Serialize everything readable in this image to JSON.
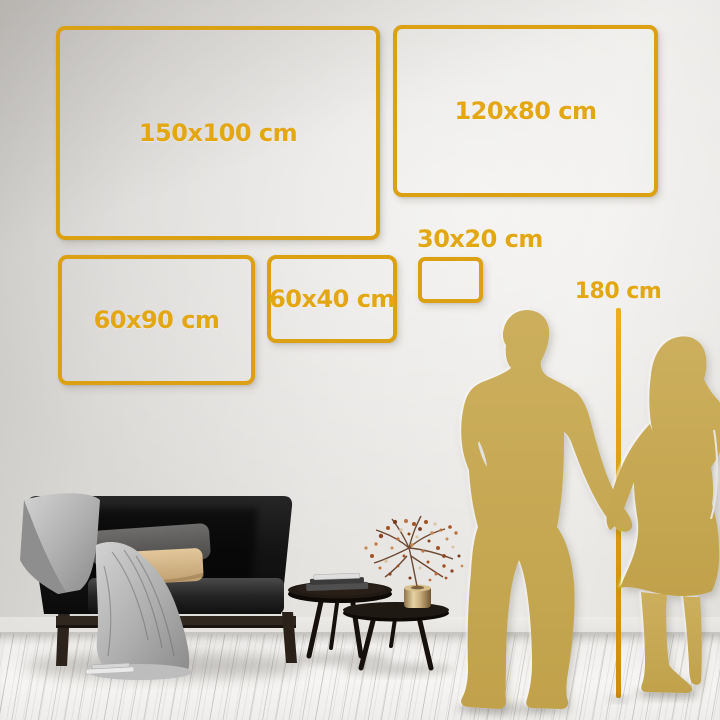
{
  "size_comparison": {
    "frames": [
      {
        "label": "150x100 cm"
      },
      {
        "label": "120x80 cm"
      },
      {
        "label": "60x90 cm"
      },
      {
        "label": "60x40 cm"
      },
      {
        "label": "30x20 cm"
      }
    ],
    "height_marker_label": "180 cm"
  },
  "colors": {
    "frame_gold": "#dca112",
    "label_gold": "#e3a714",
    "silhouette_gold": "#c8aa54",
    "wall_gray": "#e5e3e0",
    "floor_white": "#f4f3f1"
  },
  "scene_elements": [
    "gray-wall",
    "wood-plank-floor",
    "black-sofa",
    "gray-throw-blanket",
    "gray-pillow",
    "beige-pillow",
    "nesting-coffee-tables",
    "book-stack",
    "brass-vase",
    "dried-flower-branches",
    "man-silhouette",
    "woman-silhouette",
    "height-measure-line"
  ]
}
